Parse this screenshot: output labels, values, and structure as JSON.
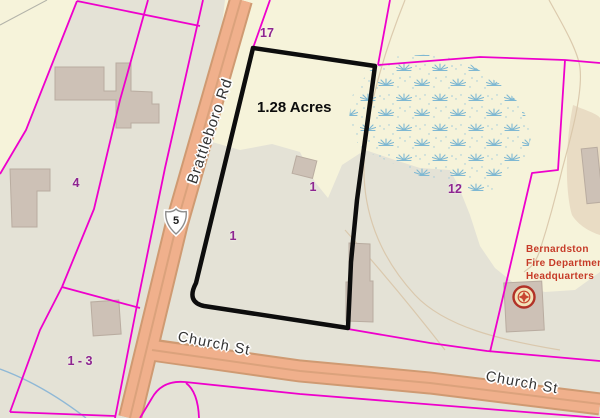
{
  "highlighted_parcel": {
    "area_label": "1.28 Acres",
    "outline_color": "#0d0d0d"
  },
  "roads": {
    "brattleboro_rd": {
      "name": "Brattleboro Rd",
      "route_shield": "5"
    },
    "church_st_upper": {
      "name": "Church St"
    },
    "church_st_lower": {
      "name": "Church St"
    },
    "fill_color": "#f0b08c",
    "casing_color": "#cf9a72"
  },
  "parcel_ids": {
    "p17": "17",
    "p4": "4",
    "p1_roadside": "1",
    "p1_highlighted": "1",
    "p12": "12",
    "p1_3": "1 - 3"
  },
  "poi": {
    "fire_hq": {
      "line1": "Bernardston",
      "line2": "Fire Department",
      "line3": "Headquarters",
      "text_color": "#c63b28"
    }
  },
  "colors": {
    "parcel_line": "#ee00cc",
    "parcel_label": "#8e2590",
    "bg_developed": "#e4e2d6",
    "bg_undeveloped": "#f6f3da",
    "wetland_symbol": "#7fb8d2",
    "building": "#cdc1b6",
    "contour": "#d9c6a9",
    "stream": "#8fb8d6",
    "tan_landcover": "#e9dcc4"
  }
}
